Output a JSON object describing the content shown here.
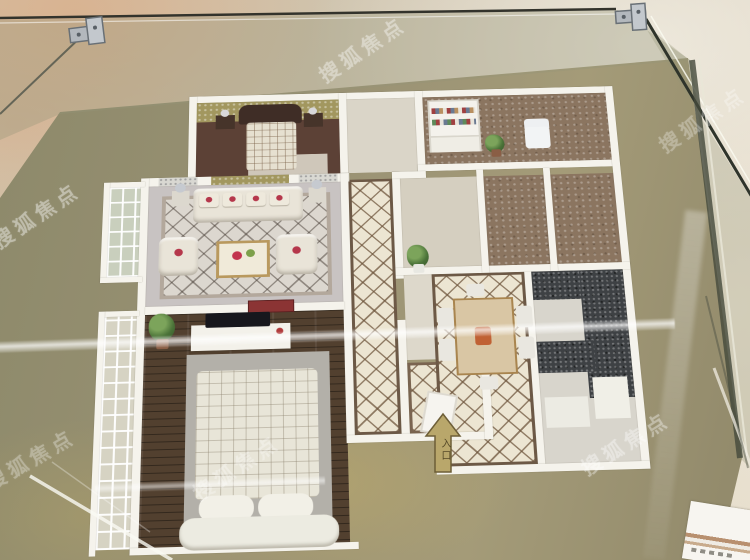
{
  "scene": {
    "type": "photograph",
    "description": "Miniature architectural model of an apartment floor plan displayed under a glass case on a beige marble floor",
    "watermark": {
      "text": "搜狐焦点",
      "style": "translucent white diagonal, repeated"
    },
    "entrance_arrow": {
      "label": "入口",
      "fill": "#b9a76b",
      "outline": "#6d5e37"
    },
    "palette": {
      "marble_floor": "#cfc3ad",
      "marble_highlight": "#e6decd",
      "marble_pink_vein": "#d9b99e",
      "model_base": "#9a9274",
      "walls": "#f5f3ec",
      "wood_floor": "#52402f",
      "tile_floor": "#ece5d2",
      "tile_lattice": "#6d5946",
      "living_rug": "#dcd7cf",
      "accent_wallpaper": "#a2975f",
      "granite_counter": "#3e4144",
      "glass_frame": "#33332c",
      "clamp_metal": "#b3b8bd"
    },
    "rooms": [
      {
        "name": "master bedroom"
      },
      {
        "name": "living room"
      },
      {
        "name": "study"
      },
      {
        "name": "corridor"
      },
      {
        "name": "second bedroom"
      },
      {
        "name": "dining room"
      },
      {
        "name": "kitchen"
      },
      {
        "name": "bathroom"
      },
      {
        "name": "balcony upper"
      },
      {
        "name": "balcony lower"
      }
    ]
  }
}
